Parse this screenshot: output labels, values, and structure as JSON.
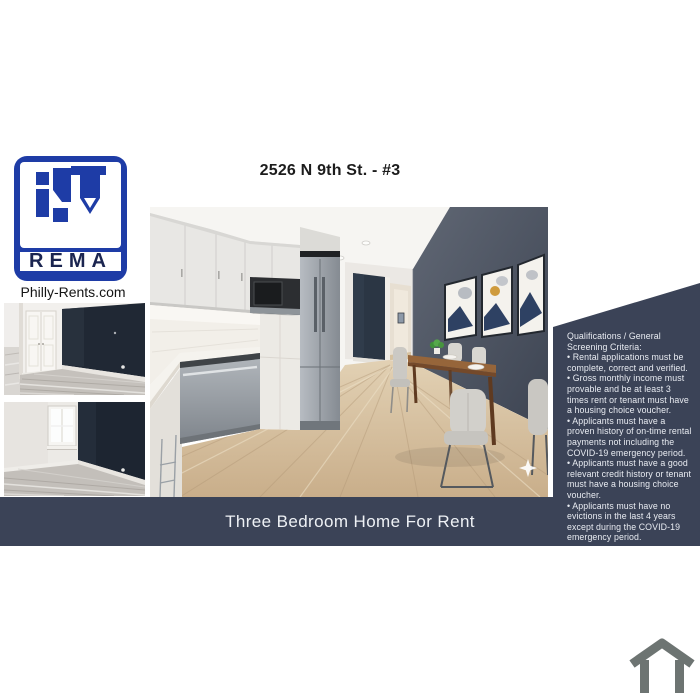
{
  "colors": {
    "brand-blue": "#1e3ca6",
    "logo-letters": "#1b2550",
    "website-text": "#141414",
    "title-text": "#1c1c1c",
    "navy-panel": "#3b4357",
    "banner-text": "#eef1f5",
    "panel-text": "#e9ecf2",
    "house-icon-gray": "#6d7472",
    "accent-wall": "#49505f",
    "dark-accent-wall": "#1f2734"
  },
  "header": {
    "title": "2526 N 9th St. - #3"
  },
  "brand": {
    "logo_text": "REMA",
    "website": "Philly-Rents.com"
  },
  "banner": {
    "text": "Three Bedroom Home For Rent"
  },
  "qualifications": {
    "heading": "Qualifications / General Screening Criteria:",
    "items": [
      "• Rental applications must be complete, correct and verified.",
      "• Gross monthly income must provable and be at least 3 times rent or tenant must have a housing choice voucher.",
      "• Applicants must have a proven history of on-time rental payments not including the COVID-19 emergency period.",
      "• Applicants must have a good relevant credit history or tenant must have a housing choice voucher.",
      "• Applicants must have no evictions in the last 4 years except during the COVID-19 emergency period."
    ]
  },
  "icons": {
    "footer": "house-outline-icon",
    "photo_watermark": "sparkle-icon"
  }
}
